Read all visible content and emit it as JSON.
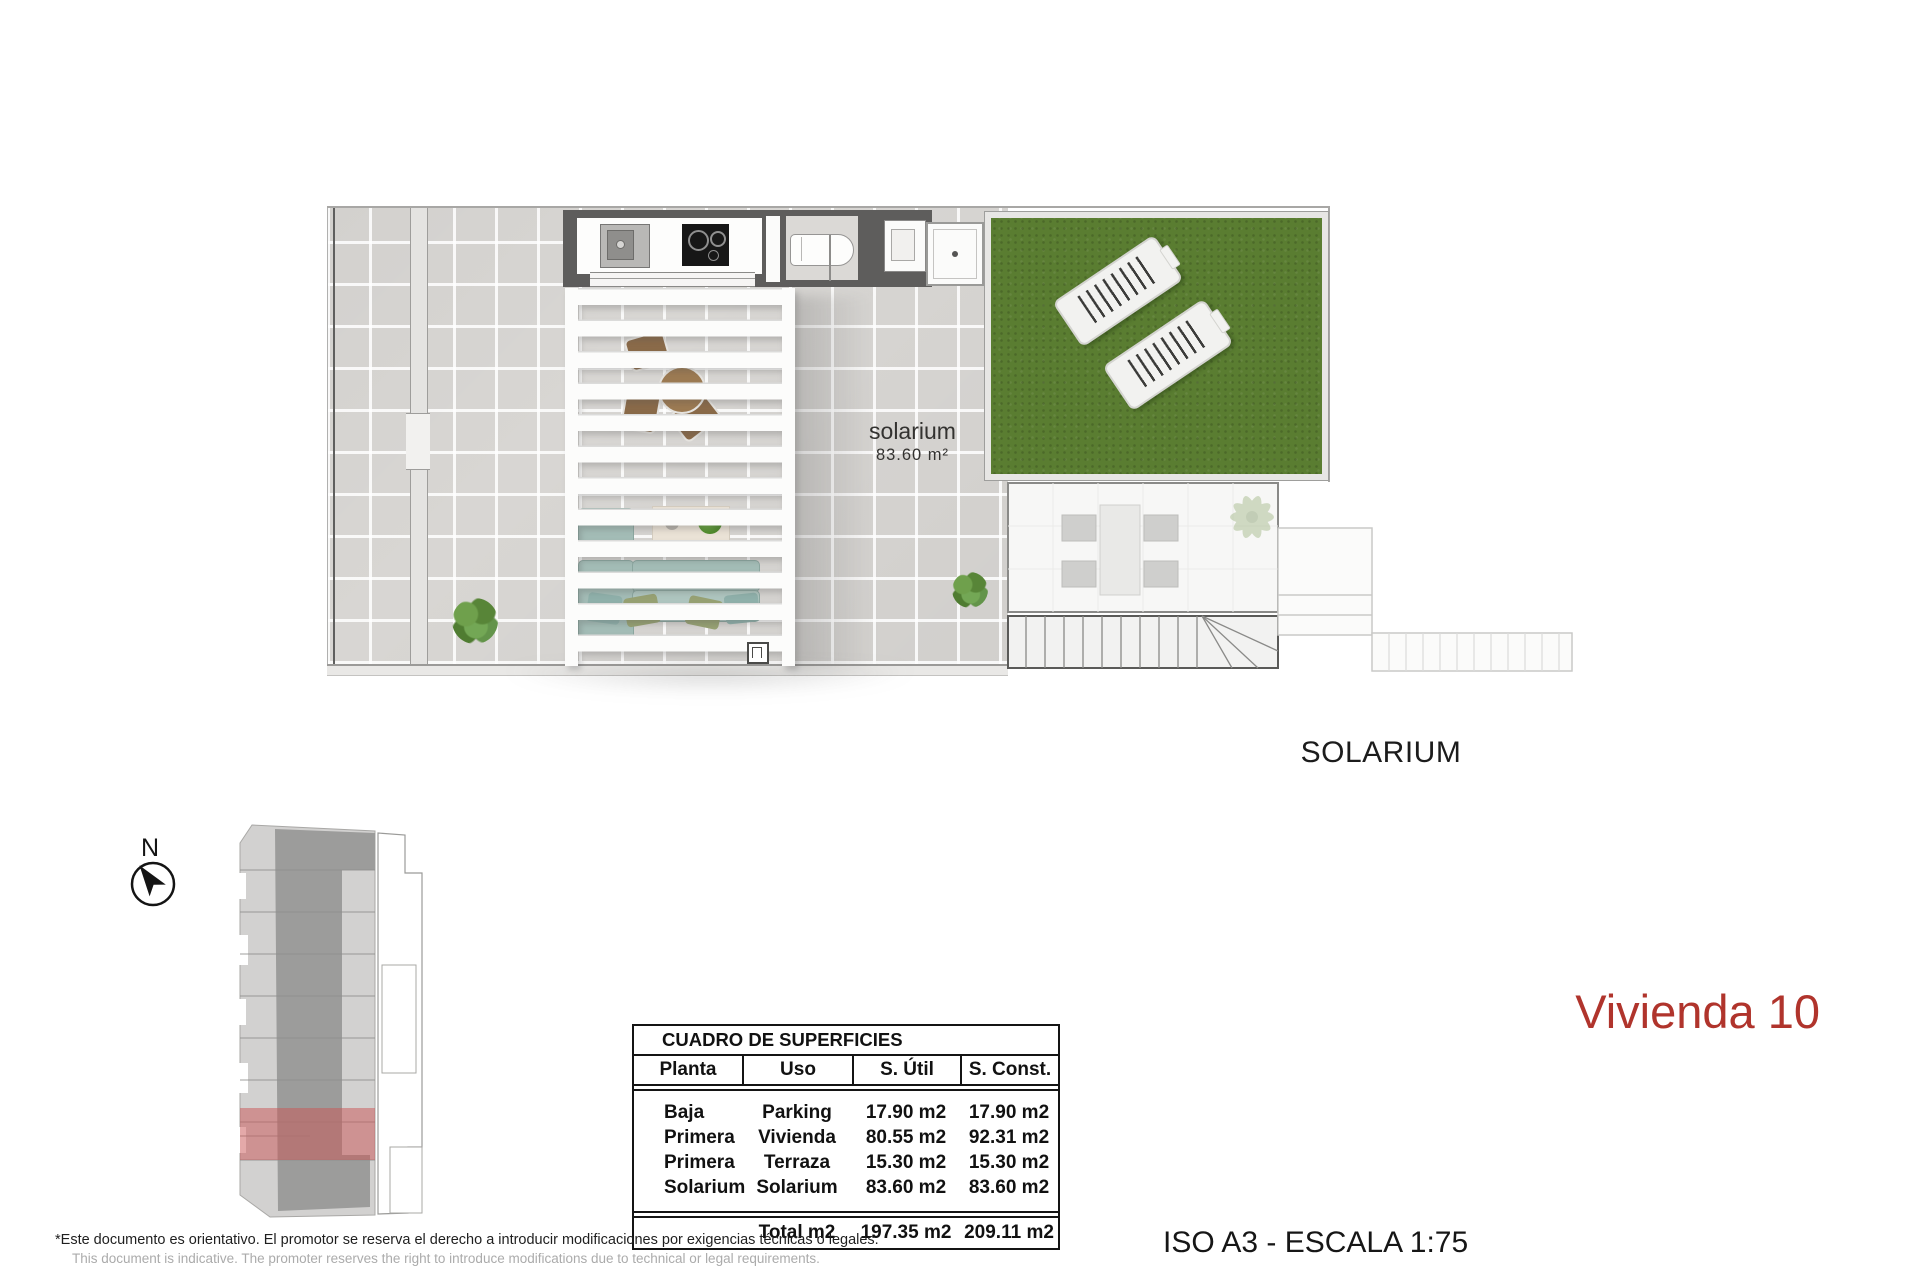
{
  "plan": {
    "room_label": "solarium",
    "room_area": "83.60 m²",
    "caption": "SOLARIUM"
  },
  "key_plan": {
    "north_label": "N"
  },
  "surface_table": {
    "title": "CUADRO DE SUPERFICIES",
    "headers": [
      "Planta",
      "Uso",
      "S. Útil",
      "S. Const."
    ],
    "rows": [
      {
        "planta": "Baja",
        "uso": "Parking",
        "util": "17.90 m2",
        "const": "17.90 m2"
      },
      {
        "planta": "Primera",
        "uso": "Vivienda",
        "util": "80.55 m2",
        "const": "92.31 m2"
      },
      {
        "planta": "Primera",
        "uso": "Terraza",
        "util": "15.30 m2",
        "const": "15.30 m2"
      },
      {
        "planta": "Solarium",
        "uso": "Solarium",
        "util": "83.60 m2",
        "const": "83.60 m2"
      }
    ],
    "total": {
      "label": "Total m2",
      "util": "197.35 m2",
      "const": "209.11 m2"
    }
  },
  "unit_title": {
    "text": "Vivienda 10"
  },
  "format_scale": "ISO A3 - ESCALA 1:75",
  "disclaimer": {
    "es": "*Este documento es orientativo. El promotor se reserva el derecho a introducir modificaciones por exigencias técnicas o legales.",
    "en": "This document is indicative. The promoter reserves the right to introduce modifications due to technical or legal requirements."
  },
  "colors": {
    "accent_red": "#b0342c",
    "highlight_red": "#d08a8a",
    "grass_green": "#5a7d31",
    "tile_gray": "#d8d6d3",
    "wall_dark": "#5e5d5c"
  }
}
